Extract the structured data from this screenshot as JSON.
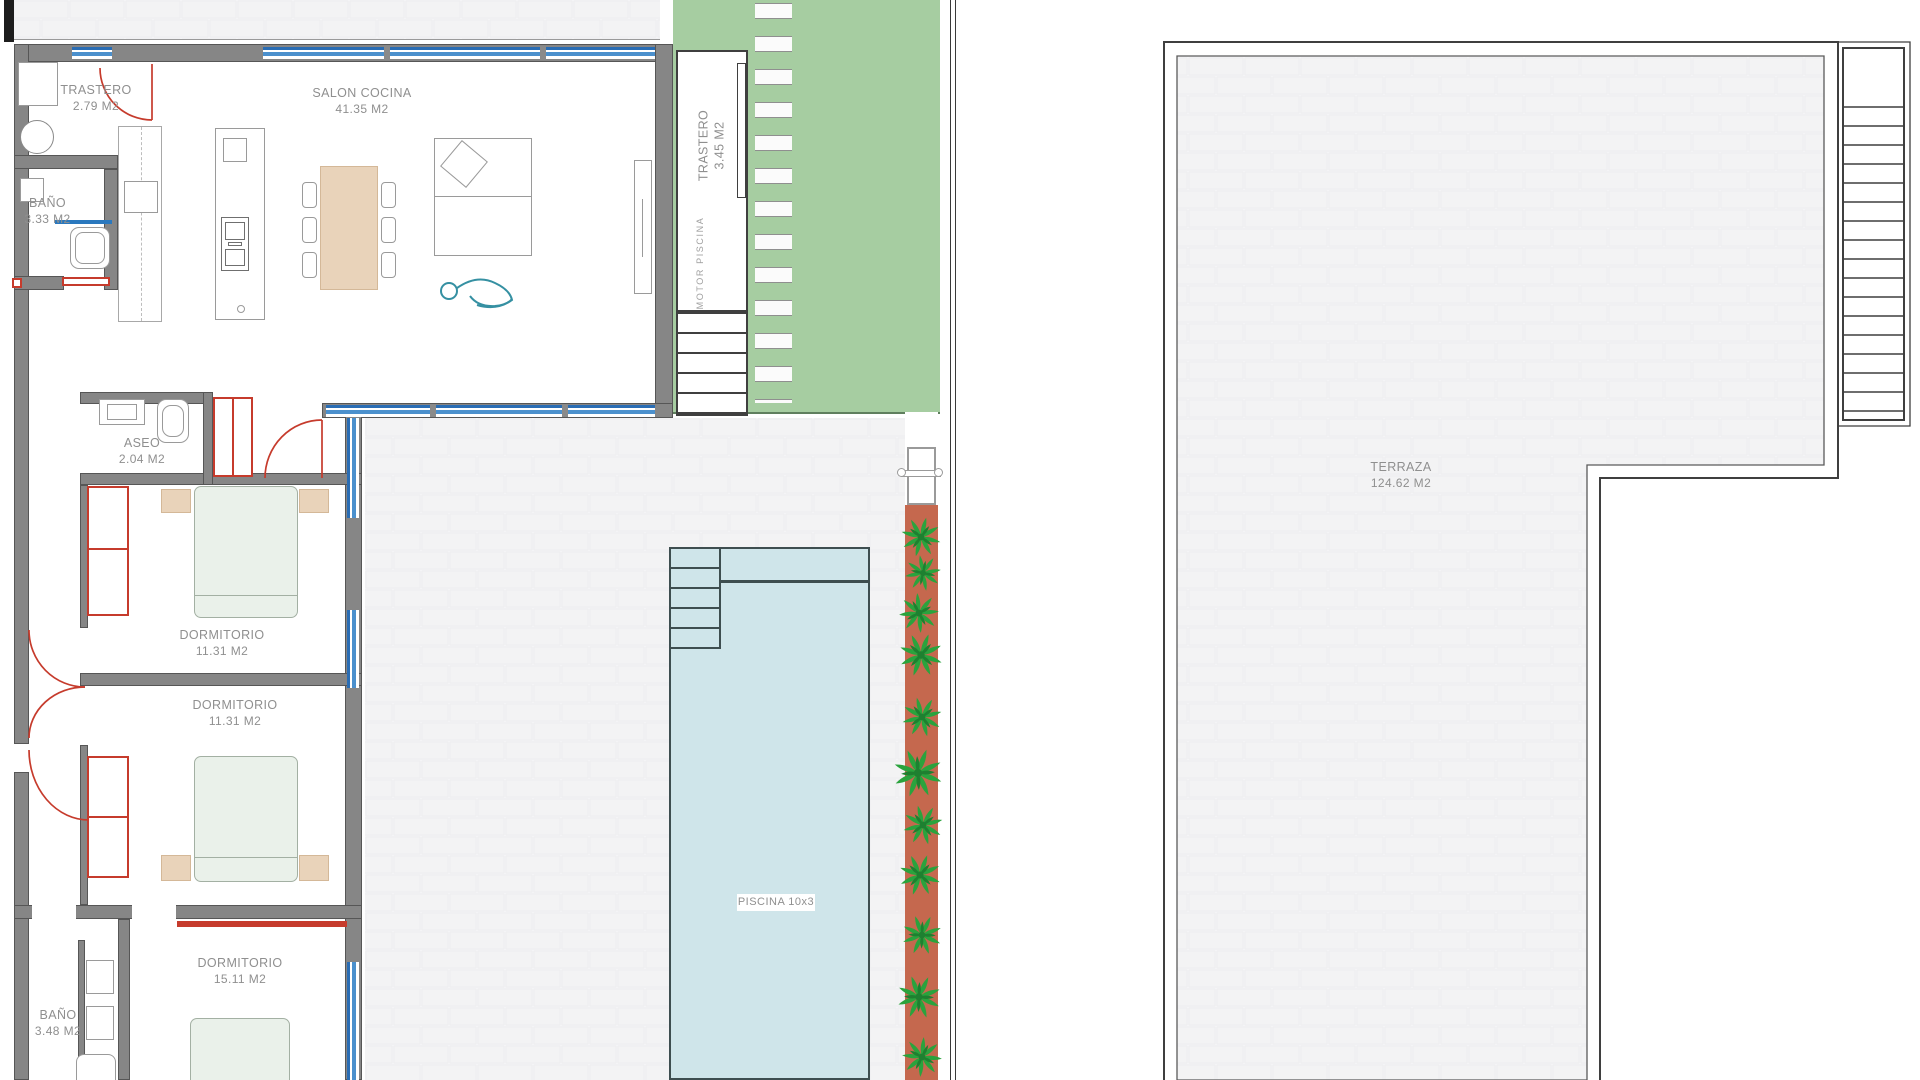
{
  "plan_title": "Floor plan - villa ground floor with pool and roof terrace",
  "rooms": {
    "trastero_entrada": {
      "name": "TRASTERO",
      "area": "2.79 M2"
    },
    "salon_cocina": {
      "name": "SALON COCINA",
      "area": "41.35 M2"
    },
    "bano_1": {
      "name": "BAÑO",
      "area": "3.33 M2"
    },
    "trastero_exterior": {
      "name": "TRASTERO",
      "area": "3.45 M2"
    },
    "motor_piscina": {
      "name": "MOTOR PISCINA"
    },
    "aseo": {
      "name": "ASEO",
      "area": "2.04 M2"
    },
    "dormitorio_1": {
      "name": "DORMITORIO",
      "area": "11.31 M2"
    },
    "dormitorio_2": {
      "name": "DORMITORIO",
      "area": "11.31 M2"
    },
    "dormitorio_3": {
      "name": "DORMITORIO",
      "area": "15.11 M2"
    },
    "bano_2": {
      "name": "BAÑO",
      "area": "3.48 M2"
    },
    "piscina": {
      "label": "PISCINA 10x3"
    },
    "terraza": {
      "name": "TERRAZA",
      "area": "124.62 M2"
    }
  },
  "colors": {
    "wall_gray": "#868686",
    "door_wardrobe_red": "#c63b2c",
    "window_blue": "#2a6db4",
    "pool_water": "#cfe5ea",
    "pool_edge": "#3e4e50",
    "lawn_green": "#a6cda1",
    "planter_terracotta": "#c5684e",
    "plant_green": "#2aa33d",
    "paver_fill": "#f3f3f4",
    "label_gray": "#8f8f8f",
    "bed_green": "#eaf1ea",
    "furniture_tan": "#e9d3ba"
  }
}
